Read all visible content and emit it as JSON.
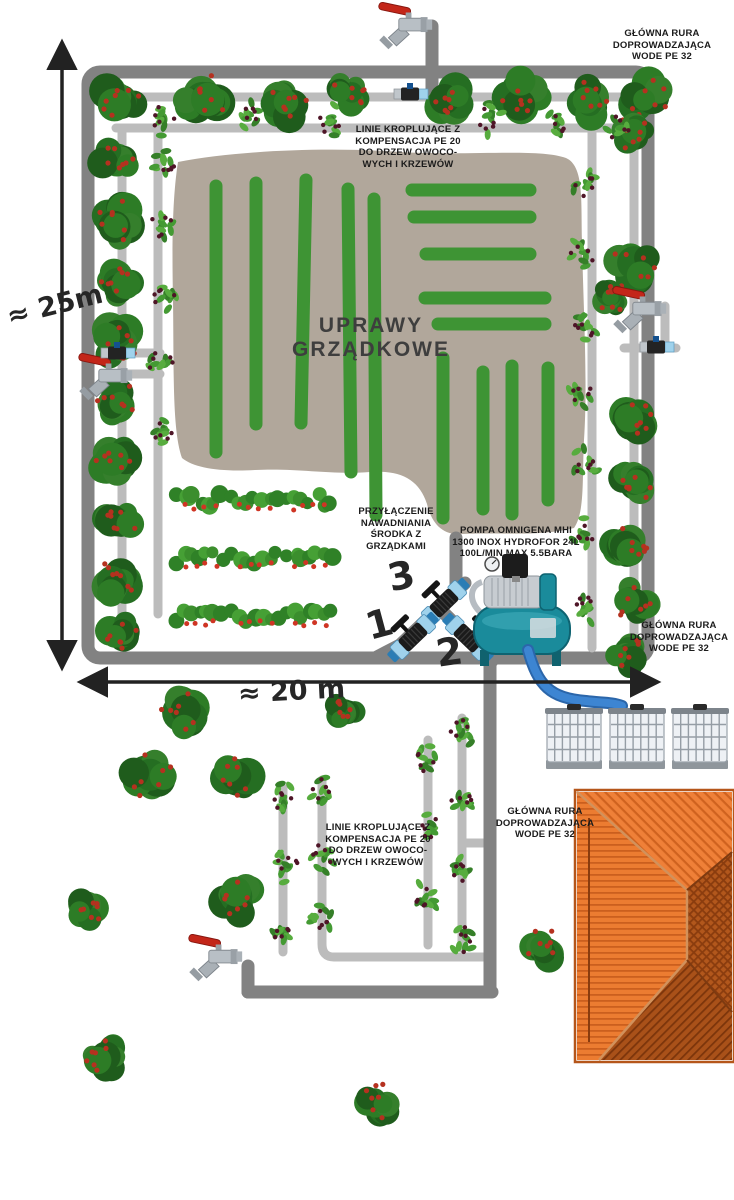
{
  "labels": {
    "main_pipe": "GŁÓWNA RURA\nDOPROWADZAJĄCA\nWODE PE 32",
    "drip_lines": "LINIE KROPLUJĄCE Z\nKOMPENSACJA PE 20\nDO DRZEW OWOCO-\nWYCH I KRZEWÓW",
    "beds": "UPRAWY\nGRZĄDKOWE",
    "bed_connection": "PRZYŁĄCZENIE\nNAWADNIANIA\nŚRODKA Z\nGRZĄDKAMI",
    "pump": "POMPA OMNIGENA MHI\n1300 INOX HYDROFOR 24L\n100L/MIN MAX 5.5BARA",
    "dim_height": "≈ 25m",
    "dim_width": "≈ 20 m",
    "valve_1": "1",
    "valve_2": "2",
    "valve_3": "3"
  },
  "colors": {
    "pipe_main": "#828282",
    "pipe_drip": "#bcbcbc",
    "bed_fill": "#b1a79b",
    "drip_green": "#3e9434",
    "tap_red": "#c32619",
    "valve_blue": "#9fd2ec",
    "pump_teal": "#1a8b9b",
    "hose_blue": "#3d85d2",
    "tank_body": "#eef1f5",
    "arrow_black": "#222222"
  },
  "diagram": {
    "outer_rect": {
      "x": 88,
      "y": 72,
      "w": 560,
      "h": 586,
      "rx": 12
    },
    "main_pipes": [
      "M432 26 V96",
      "M375 658 L400 645 L465 583",
      "M456 588 V538",
      "M441 610 L492 661",
      "M490 658 V992",
      "M248 992 H492",
      "M248 992 V966"
    ],
    "drip_pipes": [
      "M105 97 H645",
      "M116 128 H636",
      "M122 130 V620",
      "M158 130 V614",
      "M592 106 V648",
      "M634 99 V652",
      "M120 353 H160",
      "M128 374 H160",
      "M665 306 V348",
      "M624 348 H676",
      "M283 788 V952",
      "M322 780 V944 Q322 957 334 957 H488",
      "M428 740 V945",
      "M462 718 V948",
      "M462 843 H488"
    ],
    "green_lines": [
      [
        216,
        186,
        216,
        452
      ],
      [
        256,
        183,
        256,
        424
      ],
      [
        306,
        180,
        301,
        423
      ],
      [
        348,
        189,
        351,
        472
      ],
      [
        374,
        199,
        376,
        515
      ],
      [
        412,
        190,
        530,
        190
      ],
      [
        414,
        217,
        530,
        217
      ],
      [
        426,
        254,
        530,
        254
      ],
      [
        425,
        298,
        545,
        298
      ],
      [
        438,
        324,
        545,
        324
      ],
      [
        443,
        358,
        443,
        518
      ],
      [
        483,
        372,
        483,
        509
      ],
      [
        512,
        366,
        512,
        514
      ],
      [
        548,
        368,
        548,
        500
      ]
    ],
    "bed_path": "M178 162 C240 150 330 147 400 152 C470 156 540 148 566 158 C584 166 581 200 582 240 C583 300 588 380 584 440 C582 480 585 512 574 528 C540 537 500 532 462 534 C441 536 431 521 427 504 C419 479 400 470 370 472 C330 475 300 468 255 470 C220 472 194 468 182 458 C172 430 174 370 173 300 C172 250 172 200 178 162 Z",
    "trees": [
      [
        118,
        100,
        34
      ],
      [
        203,
        97,
        36
      ],
      [
        286,
        102,
        30
      ],
      [
        350,
        93,
        27
      ],
      [
        455,
        100,
        32
      ],
      [
        523,
        95,
        33
      ],
      [
        590,
        100,
        30
      ],
      [
        646,
        97,
        32
      ],
      [
        117,
        160,
        30
      ],
      [
        117,
        222,
        32
      ],
      [
        116,
        282,
        30
      ],
      [
        118,
        342,
        32
      ],
      [
        116,
        402,
        30
      ],
      [
        118,
        462,
        32
      ],
      [
        116,
        522,
        30
      ],
      [
        118,
        580,
        32
      ],
      [
        121,
        634,
        28
      ],
      [
        633,
        132,
        26
      ],
      [
        632,
        265,
        34
      ],
      [
        612,
        297,
        24
      ],
      [
        630,
        420,
        32
      ],
      [
        634,
        482,
        28
      ],
      [
        626,
        545,
        30
      ],
      [
        636,
        602,
        30
      ],
      [
        629,
        652,
        28
      ],
      [
        185,
        715,
        36
      ],
      [
        150,
        777,
        34
      ],
      [
        237,
        777,
        33
      ],
      [
        345,
        712,
        22
      ],
      [
        88,
        908,
        28
      ],
      [
        237,
        898,
        30
      ],
      [
        543,
        948,
        28
      ],
      [
        105,
        1057,
        27
      ],
      [
        379,
        1102,
        26
      ]
    ],
    "berries": [
      [
        162,
        118
      ],
      [
        246,
        113
      ],
      [
        330,
        122
      ],
      [
        490,
        118
      ],
      [
        558,
        121
      ],
      [
        618,
        126
      ],
      [
        163,
        160
      ],
      [
        161,
        228
      ],
      [
        164,
        296
      ],
      [
        160,
        364
      ],
      [
        163,
        430
      ],
      [
        585,
        185
      ],
      [
        583,
        255
      ],
      [
        586,
        325
      ],
      [
        582,
        392
      ],
      [
        586,
        462
      ],
      [
        583,
        535
      ],
      [
        587,
        608
      ],
      [
        283,
        800
      ],
      [
        285,
        865
      ],
      [
        281,
        930
      ],
      [
        322,
        790
      ],
      [
        324,
        856
      ],
      [
        320,
        920
      ],
      [
        428,
        760
      ],
      [
        430,
        828
      ],
      [
        426,
        898
      ],
      [
        462,
        730
      ],
      [
        464,
        800
      ],
      [
        460,
        870
      ],
      [
        463,
        940
      ]
    ],
    "strawberries": [
      [
        200,
        500
      ],
      [
        255,
        500
      ],
      [
        310,
        500
      ],
      [
        200,
        558
      ],
      [
        255,
        558
      ],
      [
        310,
        558
      ],
      [
        200,
        616
      ],
      [
        255,
        616
      ],
      [
        310,
        616
      ]
    ],
    "taps": [
      [
        408,
        24
      ],
      [
        108,
        375
      ],
      [
        642,
        308
      ],
      [
        218,
        956
      ]
    ],
    "small_valves": [
      [
        410,
        94
      ],
      [
        117,
        353
      ],
      [
        656,
        347
      ]
    ],
    "big_valves": [
      [
        444,
        603,
        -44
      ],
      [
        413,
        637,
        -44
      ],
      [
        468,
        638,
        44
      ]
    ],
    "pump": {
      "x": 468,
      "y": 550
    },
    "hose": "M528 650 C538 686 550 698 586 701 C600 703 612 702 622 706",
    "tanks": [
      [
        545,
        704
      ],
      [
        608,
        704
      ],
      [
        671,
        704
      ]
    ],
    "roof": {
      "x": 575,
      "y": 790,
      "w": 159,
      "h": 272
    },
    "dim_arrows": [
      [
        62,
        48,
        62,
        662
      ],
      [
        86,
        682,
        652,
        682
      ]
    ]
  }
}
